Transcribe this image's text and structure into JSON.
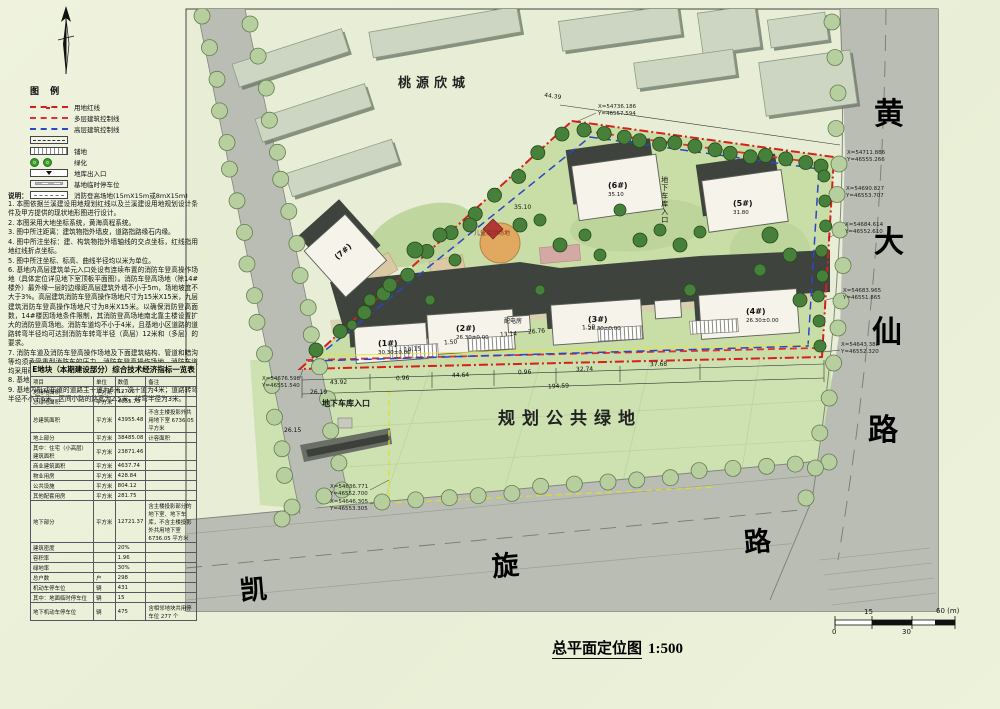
{
  "page": {
    "title": "总平面定位图",
    "scale": "1:500"
  },
  "legend": {
    "title": "图 例",
    "items": [
      {
        "label": "用地红线",
        "type": "red-dashdot"
      },
      {
        "label": "多层建筑控制线",
        "type": "red-dash"
      },
      {
        "label": "高层建筑控制线",
        "type": "blue-dash"
      },
      {
        "label": "",
        "type": "box-line"
      },
      {
        "label": "铺地",
        "type": "hatch"
      },
      {
        "label": "绿化",
        "type": "trees"
      },
      {
        "label": "地库出入口",
        "type": "entry"
      },
      {
        "label": "基地临时停车位",
        "type": "parking"
      },
      {
        "label": "消防登高场地(15mX15m或8mX15m)",
        "type": "fire"
      }
    ]
  },
  "notes": {
    "title": "说明：",
    "lines": [
      "1. 本图依据兰溪建设用地规划红线以及兰溪建设用地规划设计条件及甲方提供的现状地形图进行设计。",
      "2. 本图采用大地坐标系统，黄海高程系统。",
      "3. 图中所注距离：建筑物指外墙皮，道路指路缘石内缘。",
      "4. 图中所注坐标：建、构筑物指外墙轴线的交点坐标，红线指用地红线折点坐标。",
      "5. 图中所注坐标、标高、曲线半径均以米为单位。",
      "6. 基地内高层建筑单元入口处设有连续布置的消防车登高操作场地（具体定位详见地下室顶板平面图）。消防车登高场地（除14#楼外）最外缘一层的边缘距高层建筑外墙不小于5m，场地坡度不大于3%。高层建筑消防车登高操作场地尺寸为15米X15米，九层建筑消防车登高操作场地尺寸为8米X15米。以确保消防登高面数，14#楼因场地条件限制，其消防登高场地南北靠主楼设置扩大的消防登高场地。消防车道均不小于4米，且基地小区道路的道路转弯半径均可达到消防车转弯半径（高层）12米和（多层）的要求。",
      "7. 消防车道及消防车登高操作场地及下面建筑结构、管道和暗沟等均须承受重型消防车的压力。消防车登高操作场地、消防车道均采用硬质铺装面层。",
      "8. 基地绿地率本图仅为示意，具体布局详见景观总平面图。",
      "9. 基地内机动车道的道路主干道为6米，次干道为4米；道路转弯半径不小于6米，区间小路的路宽为2.5米，转弯半径为3米。"
    ]
  },
  "table": {
    "title": "E地块（本期建设部分）综合技术经济指标一览表",
    "columns": [
      "项目",
      "单位",
      "数值",
      "备注"
    ],
    "rows": [
      [
        "总用地面积",
        "平方米",
        "12706",
        ""
      ],
      [
        "总绿地面积",
        "平方米",
        "4055.73",
        ""
      ],
      [
        "总建筑面积",
        "平方米",
        "43955.48",
        "不含主楼投影外共用地下室 6736.05 平方米"
      ],
      [
        "地上部分",
        "平方米",
        "38485.08",
        "计容面积"
      ],
      [
        "其中：住宅（小高层）建筑面积",
        "平方米",
        "23871.46",
        ""
      ],
      [
        "商业建筑面积",
        "平方米",
        "4637.74",
        ""
      ],
      [
        "物业用房",
        "平方米",
        "428.84",
        ""
      ],
      [
        "公共设施",
        "平方米",
        "804.12",
        ""
      ],
      [
        "其他配套用房",
        "平方米",
        "281.75",
        ""
      ],
      [
        "地下部分",
        "平方米",
        "12721.37",
        "含主楼投影部分的地下室、地下车库，不含主楼投影外共用地下室 6736.05 平方米"
      ],
      [
        "建筑密度",
        "",
        "20%",
        ""
      ],
      [
        "容积率",
        "",
        "1.96",
        ""
      ],
      [
        "绿地率",
        "",
        "30%",
        ""
      ],
      [
        "总户数",
        "户",
        "298",
        ""
      ],
      [
        "机动车停车位",
        "辆",
        "431",
        ""
      ],
      [
        "其中：地面临时停车位",
        "辆",
        "15",
        ""
      ],
      [
        "地下机动车停车位",
        "辆",
        "475",
        "含相邻地块共用停车位 277 个"
      ]
    ]
  },
  "plan": {
    "areas": {
      "north_block": "桃源欣城",
      "public_green": "规划公共绿地",
      "garage_entry_bottom": "地下车库入口",
      "garage_entry_mid": "地下车库入口",
      "power_room": "配电房",
      "play_area": "儿童活动场地"
    },
    "roads": {
      "east_chars": [
        "黄",
        "大",
        "仙",
        "路"
      ],
      "south_chars": [
        "凯",
        "旋",
        "路"
      ]
    },
    "buildings": [
      {
        "name": "(1#)",
        "elev": "30.30",
        "ground": "±0.00"
      },
      {
        "name": "(2#)",
        "elev": "26.30",
        "ground": "±0.00"
      },
      {
        "name": "(3#)",
        "elev": "26.30",
        "ground": "±0.00"
      },
      {
        "name": "(4#)",
        "elev": "26.30",
        "ground": "±0.00"
      },
      {
        "name": "(5#)",
        "elev": "31.80",
        "ground": "±0.00"
      },
      {
        "name": "(6#)",
        "elev": "35.10",
        "ground": "±0.00"
      },
      {
        "name": "(7#)",
        "elev": "",
        "ground": ""
      }
    ],
    "coords": [
      {
        "x": "X=54736.186",
        "y": "Y=46557.594"
      },
      {
        "x": "X=54711.886",
        "y": "Y=46555.266"
      },
      {
        "x": "X=54690.827",
        "y": "Y=46553.707"
      },
      {
        "x": "X=54684.614",
        "y": "Y=46552.610"
      },
      {
        "x": "X=54683.965",
        "y": "Y=46551.865"
      },
      {
        "x": "X=54643.388",
        "y": "Y=46552.320"
      },
      {
        "x": "X=54676.598",
        "y": "Y=46551.540"
      },
      {
        "x": "X=54636.771",
        "y": "Y=46552.700"
      },
      {
        "x": "X=54646.305",
        "y": "Y=46553.305"
      }
    ],
    "dims": {
      "bottom": [
        "43.92",
        "0.96",
        "44.64",
        "0.96",
        "32.74",
        "37.68"
      ],
      "outer": [
        "194.59"
      ],
      "misc": [
        "14.15",
        "1.50",
        "13.14",
        "26.76",
        "1.50",
        "44.39"
      ]
    },
    "spots": [
      "26.19",
      "26.15",
      "35.10"
    ],
    "scalebar": {
      "t0": "0",
      "t15": "15",
      "t30": "30",
      "t60": "60 (m)"
    }
  }
}
